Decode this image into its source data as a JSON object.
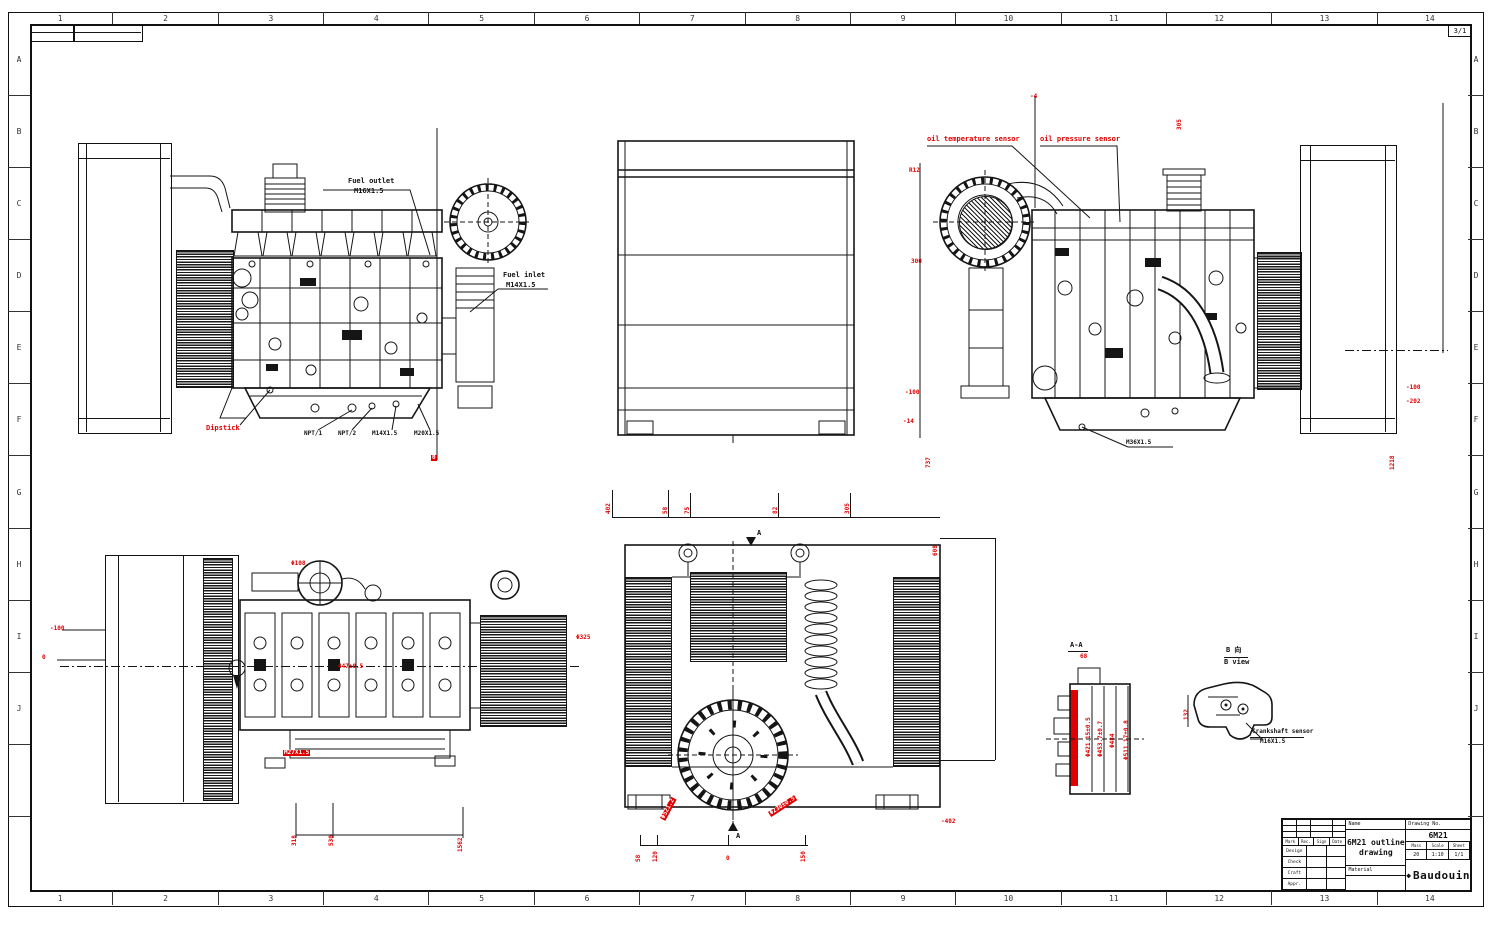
{
  "sheet": {
    "cols": [
      "1",
      "2",
      "3",
      "4",
      "5",
      "6",
      "7",
      "8",
      "9",
      "10",
      "11",
      "12",
      "13",
      "14"
    ],
    "rows": [
      "A",
      "B",
      "C",
      "D",
      "E",
      "F",
      "G",
      "H",
      "I",
      "J",
      "",
      ""
    ],
    "sheet_no": "3/1",
    "accent_red": "#e10000"
  },
  "labels": {
    "fuel_outlet1": "Fuel outlet",
    "fuel_outlet2": "M16X1.5",
    "fuel_inlet1": "Fuel inlet",
    "fuel_inlet2": "M14X1.5",
    "dipstick": "Dipstick",
    "npt": [
      "NPT/1",
      "NPT/2",
      "M14X1.5",
      "M20X1.5"
    ],
    "oil_temp": "oil temperature sensor",
    "oil_press": "oil pressure sensor",
    "m36": "M36X1.5",
    "crank1": "Crankshaft sensor",
    "crank2": "M16X1.5"
  },
  "dims": {
    "v1": {
      "zero": "0"
    },
    "v3": {
      "r12": "R12",
      "d300": "300",
      "m100": "-100",
      "m14": "-14",
      "d737": "737",
      "d1218": "1218",
      "rm100": "-100",
      "rm202": "-202",
      "m4": "-4",
      "d305": "305"
    },
    "v4": {
      "m100": "-100",
      "zero": "0",
      "d447": "447±0.5",
      "m27": "M27X1.5",
      "d108": "Φ108",
      "d325": "Φ325",
      "d318": "318",
      "d530": "530",
      "d1562": "1562"
    },
    "v5": {
      "t402": "402",
      "t58": "58",
      "t75": "75",
      "t82": "82",
      "t305": "305",
      "t608": "608",
      "b58": "58",
      "b120": "120",
      "b0": "0",
      "b150": "150",
      "rm402": "-402",
      "dphi521": "Φ521.2",
      "dphi230": "Φ230±0.5",
      "a_top": "A",
      "a_bottom": "A"
    },
    "aa": {
      "title": "A-A",
      "d68": "68",
      "list": [
        "Φ421.15±0.5",
        "Φ453.7±0.7",
        "Φ484",
        "Φ511.17±0.8"
      ]
    },
    "b": {
      "cn": "B 向",
      "en": "B view",
      "d132": "132"
    }
  },
  "title_block": {
    "name_header": "Name",
    "name_line1": "6M21 outline",
    "name_line2": "drawing",
    "drawing_no_header": "Drawing No.",
    "drawing_no": "6M21",
    "material_label": "Material",
    "logo": "Baudouin",
    "rev_cols": [
      "Mark",
      "Rec.",
      "Sign",
      "Date"
    ],
    "sign_rows": [
      "Design",
      "Check",
      "Craft",
      "Appr."
    ],
    "meta_headers": [
      "Mass",
      "Scale",
      "Sheet"
    ],
    "meta_values": [
      "20",
      "1:10",
      "1/1"
    ]
  }
}
